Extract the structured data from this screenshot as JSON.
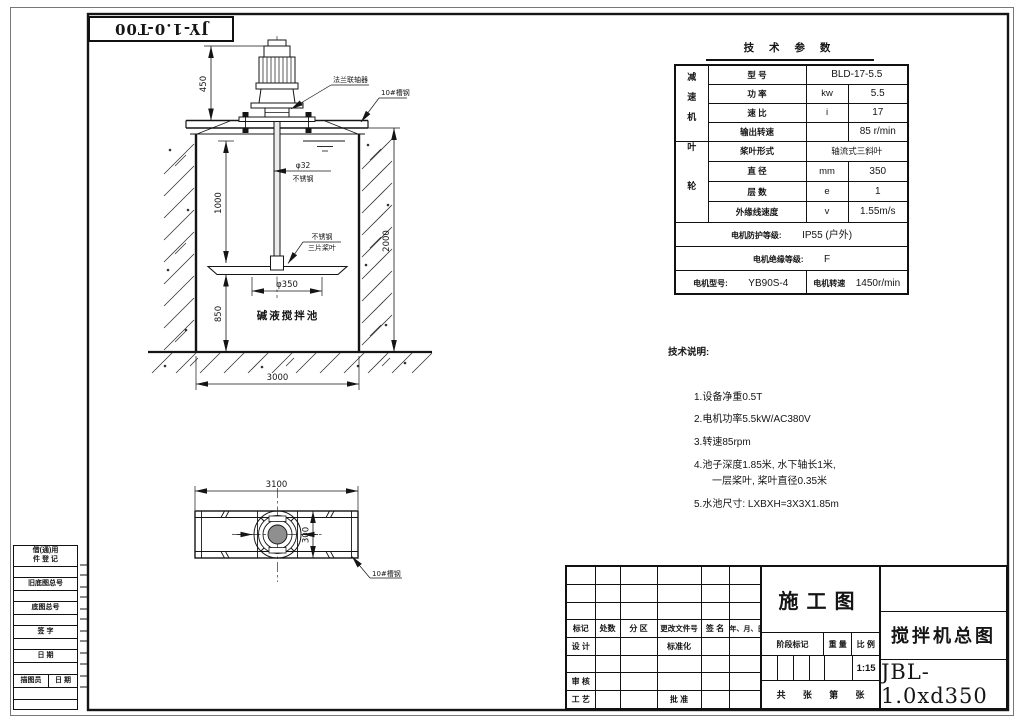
{
  "sheet": {
    "code_box": "JY-1.0-T00"
  },
  "elevation": {
    "dims": {
      "motor_height": "450",
      "underwater": "1000",
      "blade_bottom": "850",
      "depth": "2000",
      "blade_dia": "φ350",
      "width": "3000"
    },
    "labels": {
      "coupling": "法兰联轴器",
      "beam": "10#槽钢",
      "shaft_dia": "φ32",
      "shaft_mat": "不锈钢",
      "blade_mat": "不锈钢",
      "blade_type": "三片桨叶",
      "tank": "碱液搅拌池"
    }
  },
  "plan": {
    "dims": {
      "length": "3100",
      "width": "300"
    },
    "labels": {
      "beam": "10#槽钢"
    }
  },
  "params": {
    "title": "技 术 参 数",
    "reducer_group": "减速机",
    "impeller_group": "叶轮",
    "rows": [
      {
        "name": "型  号",
        "value": "BLD-17-5.5"
      },
      {
        "name": "功  率",
        "unit": "kw",
        "value": "5.5"
      },
      {
        "name": "速  比",
        "unit": "i",
        "value": "17"
      },
      {
        "name": "输出转速",
        "unit": "",
        "value": "85 r/min"
      },
      {
        "name": "桨叶形式",
        "value": "轴流式三斜叶"
      },
      {
        "name": "直  径",
        "unit": "mm",
        "value": "350"
      },
      {
        "name": "层  数",
        "unit": "e",
        "value": "1"
      },
      {
        "name": "外缘线速度",
        "unit": "v",
        "value": "1.55m/s"
      }
    ],
    "protection_label": "电机防护等级:",
    "protection_value": "IP55 (户外)",
    "insulation_label": "电机绝缘等级:",
    "insulation_value": "F",
    "motor_model_label": "电机型号:",
    "motor_model_value": "YB90S-4",
    "motor_speed_label": "电机转速",
    "motor_speed_value": "1450r/min"
  },
  "notes": {
    "title": "技术说明:",
    "item1": "1.设备净重0.5T",
    "item2": "2.电机功率5.5kW/AC380V",
    "item3": "3.转速85rpm",
    "item4a": "4.池子深度1.85米, 水下轴长1米,",
    "item4b": "一层桨叶, 桨叶直径0.35米",
    "item5": "5.水池尺寸: LXBXH=3X3X1.85m"
  },
  "title_block": {
    "stage_doc": "施工图",
    "headers": {
      "mark": "标记",
      "count": "处数",
      "zone": "分 区",
      "change_no": "更改文件号",
      "sign": "签 名",
      "date": "年、月、日"
    },
    "roles": {
      "design": "设 计",
      "standard": "标准化",
      "review": "审 核",
      "process": "工 艺",
      "approve": "批 准"
    },
    "stage_mark": "阶段标记",
    "weight": "重 量",
    "scale_label": "比 例",
    "scale": "1:15",
    "sheets": {
      "total_label": "共",
      "unit1": "张",
      "no_label": "第",
      "unit2": "张"
    },
    "title": "搅拌机总图",
    "drawing_no": "JBL-1.0xd350"
  },
  "margin_block": {
    "row1a": "借(通)用",
    "row1b": "件 登 记",
    "old_base_no": "旧底图总号",
    "base_no": "底图总号",
    "sign": "签  字",
    "date": "日  期",
    "tracer": "描图员",
    "tracer_date": "日 期"
  }
}
